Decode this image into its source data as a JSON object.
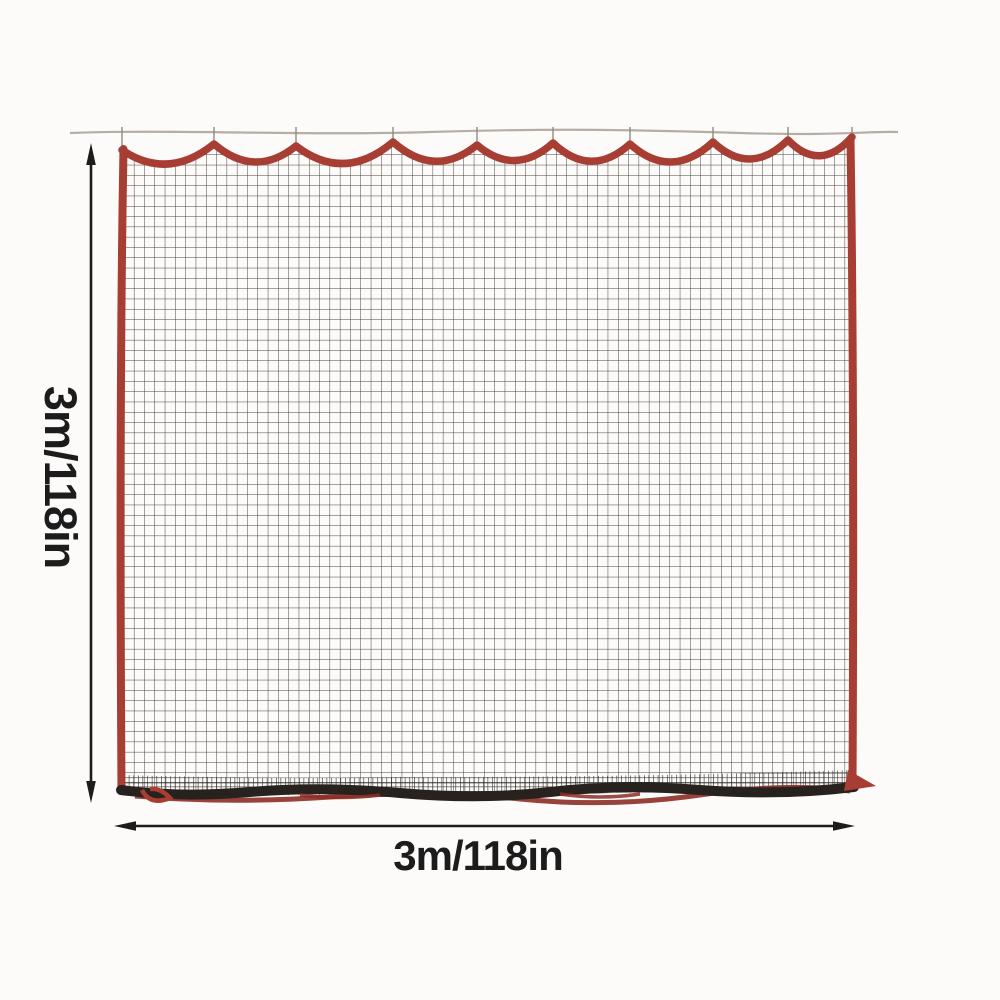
{
  "image": {
    "description": "Black sports barrier net with red trim hanging from a rod by hooks, annotated with height and width dimension arrows",
    "height_label": "3m/118in",
    "width_label": "3m/118in"
  },
  "colors": {
    "background": "#fcfbf9",
    "trim_red": "#a73d33",
    "trim_red_dark": "#8c2d26",
    "mesh_dark": "#38322d",
    "mesh_dense": "#241f1b",
    "rod_gray": "#b6ada5",
    "hook_gray": "#8f8a85",
    "annotation": "#1c1c1c"
  }
}
